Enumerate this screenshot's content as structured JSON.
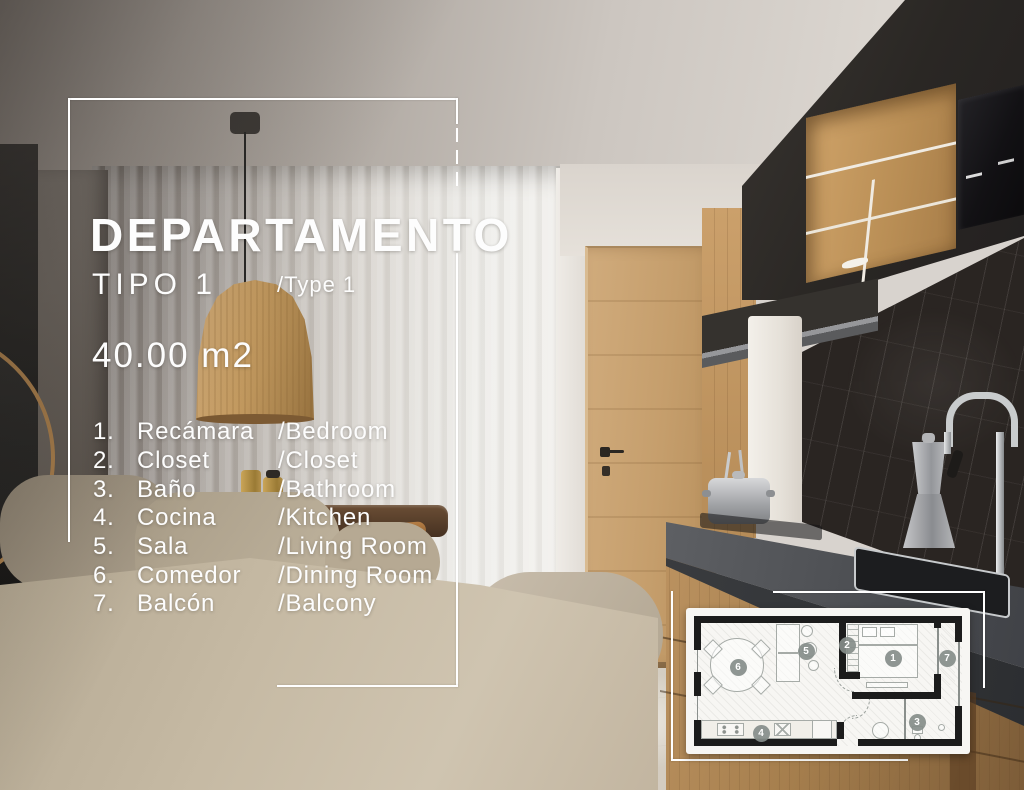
{
  "flyer": {
    "title": "DEPARTAMENTO",
    "type_label": "TIPO 1",
    "type_translation": "/Type 1",
    "area": "40.00 m2"
  },
  "room_list": [
    {
      "num": "1.",
      "name_es": "Recámara",
      "name_en": "/Bedroom"
    },
    {
      "num": "2.",
      "name_es": "Closet",
      "name_en": "/Closet"
    },
    {
      "num": "3.",
      "name_es": "Baño",
      "name_en": "/Bathroom"
    },
    {
      "num": "4.",
      "name_es": "Cocina",
      "name_en": "/Kitchen"
    },
    {
      "num": "5.",
      "name_es": "Sala",
      "name_en": "/Living Room"
    },
    {
      "num": "6.",
      "name_es": "Comedor",
      "name_en": "/Dining Room"
    },
    {
      "num": "7.",
      "name_es": "Balcón",
      "name_en": "/Balcony"
    }
  ],
  "floorplan": {
    "markers": [
      {
        "label": "1",
        "room": "bedroom"
      },
      {
        "label": "2",
        "room": "closet"
      },
      {
        "label": "3",
        "room": "bathroom"
      },
      {
        "label": "4",
        "room": "kitchen"
      },
      {
        "label": "5",
        "room": "living-room"
      },
      {
        "label": "6",
        "room": "dining-room"
      },
      {
        "label": "7",
        "room": "balcony"
      }
    ]
  },
  "colors": {
    "text": "#fdfdfd",
    "frame": "#ffffff",
    "plan_walls": "#1c1c1c",
    "plan_marker": "#868d8a",
    "wood_accent": "#c49a67"
  }
}
